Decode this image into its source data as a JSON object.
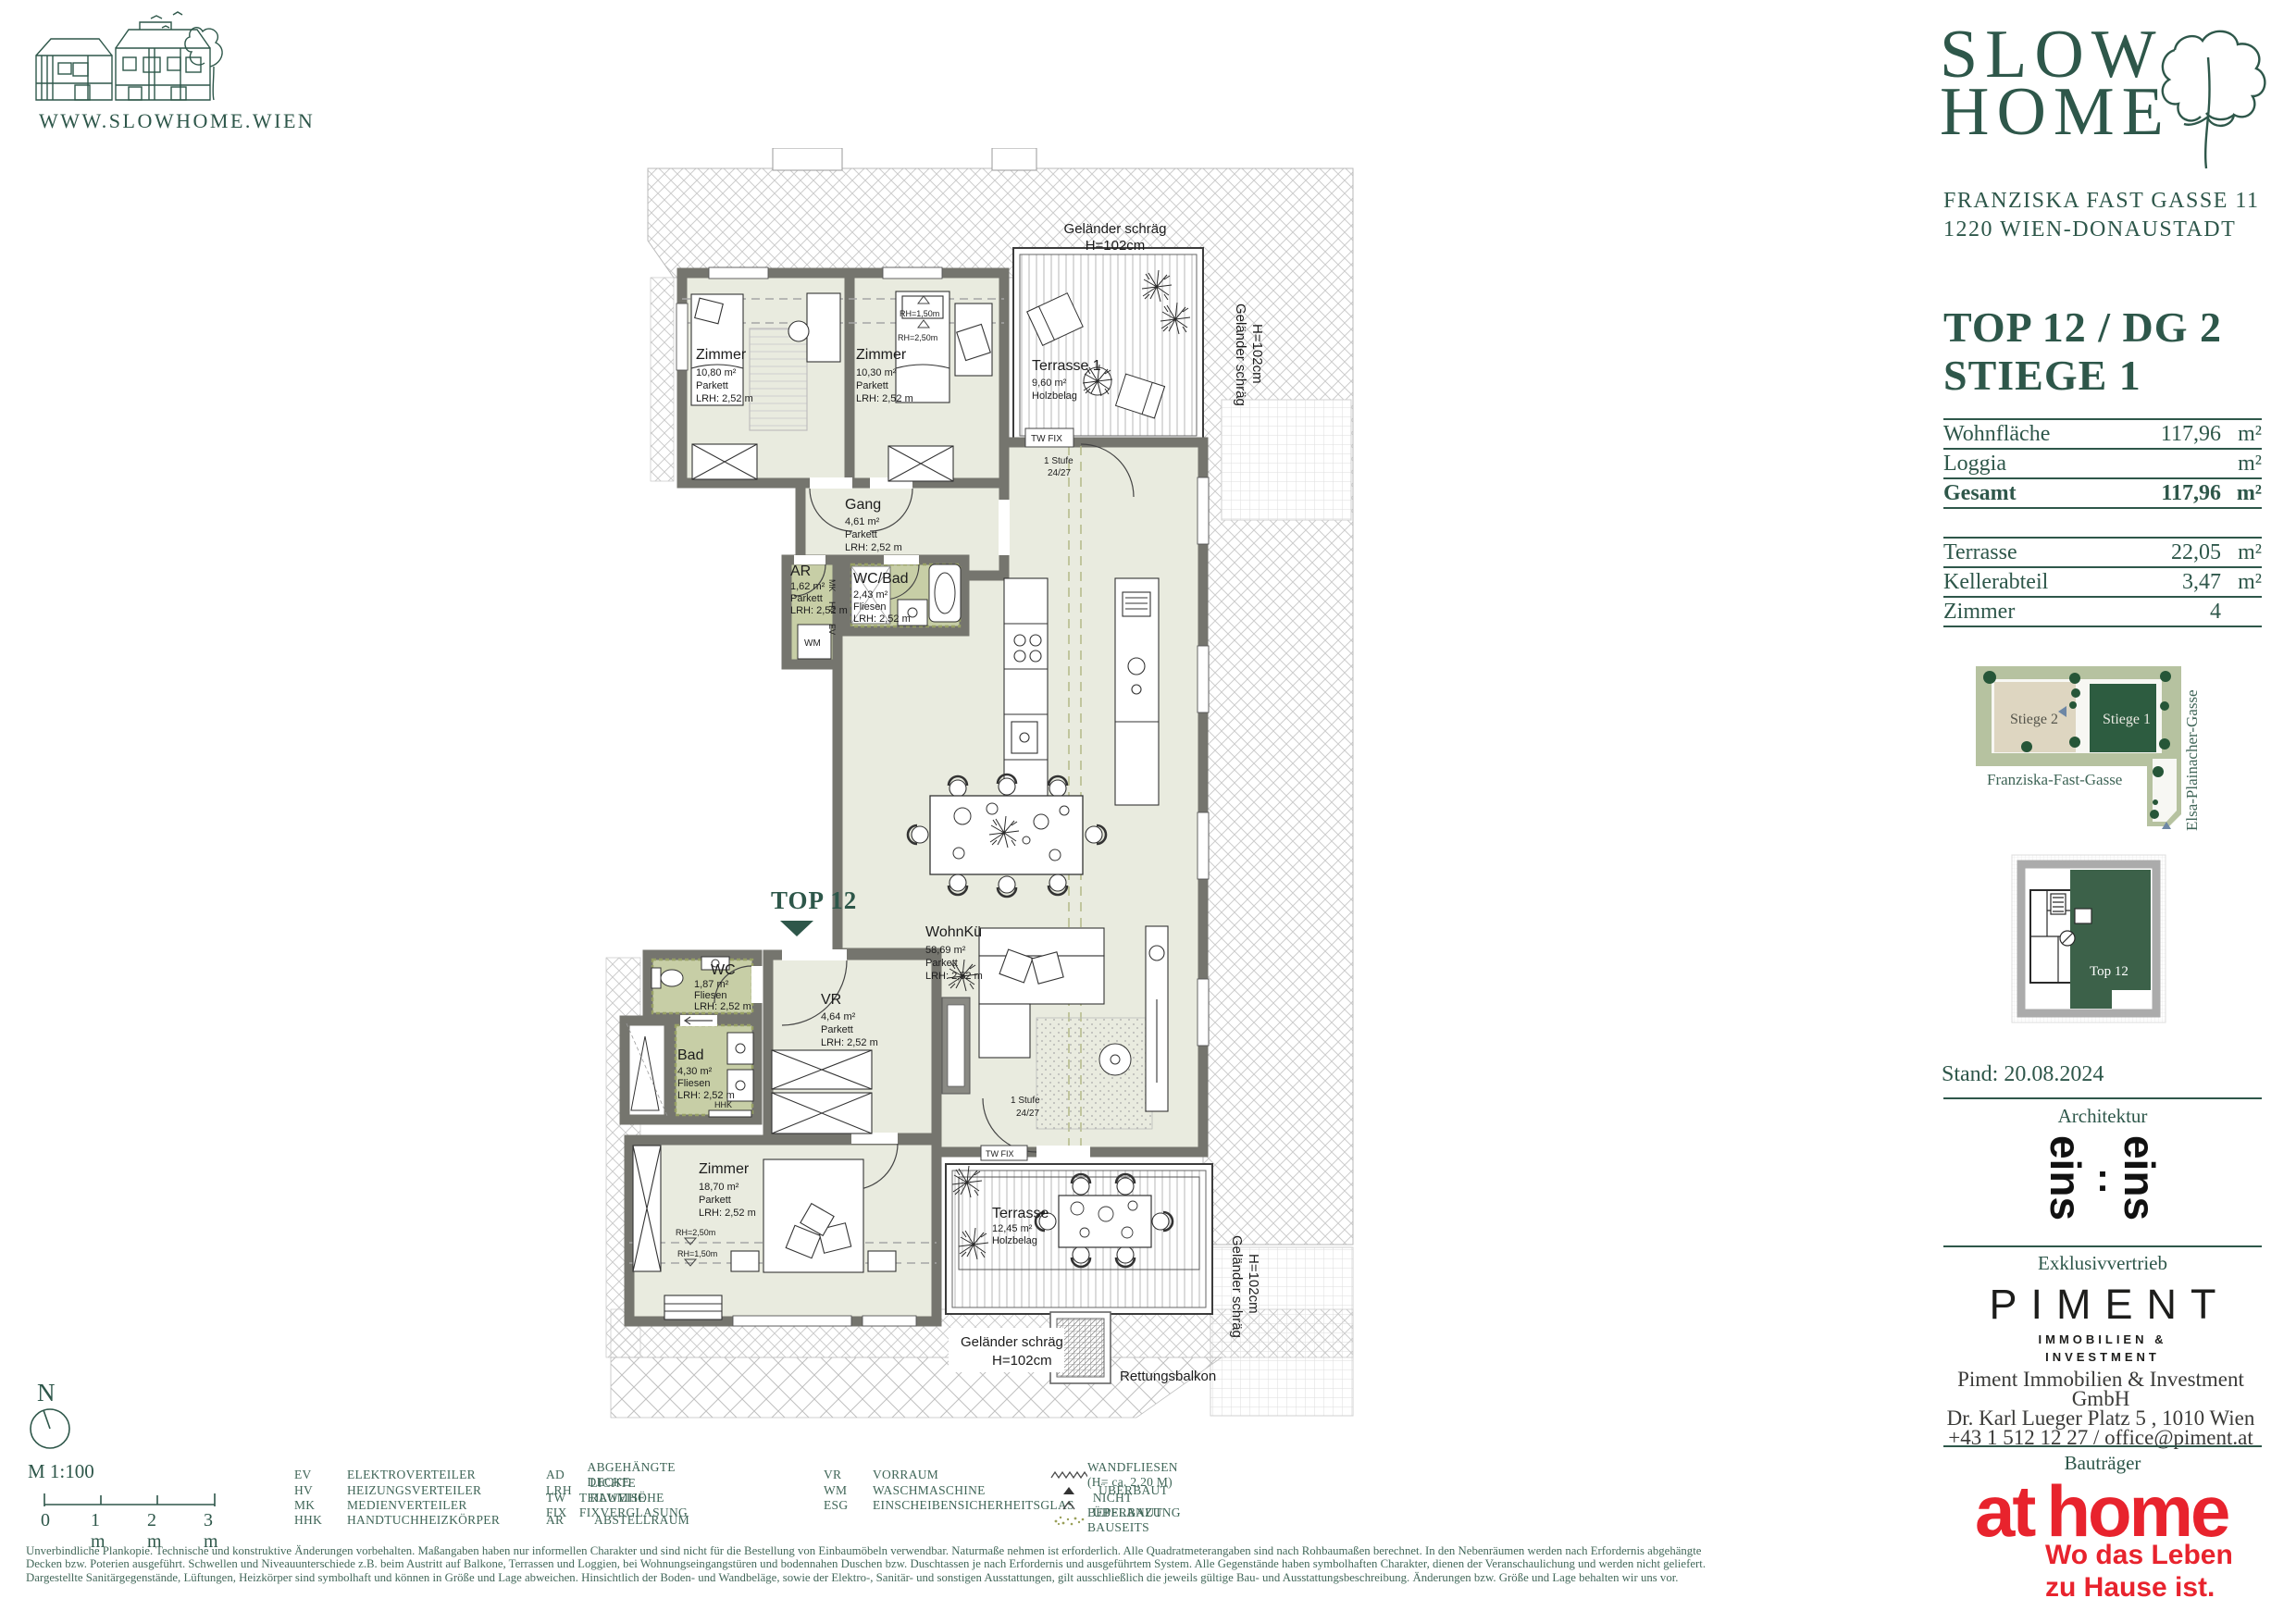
{
  "colors": {
    "brand_green": "#2e574a",
    "athome_red": "#e8232d",
    "piment_black": "#1d1d1b",
    "site_light_green": "#b6c2a0",
    "site_beige": "#ded6c1",
    "site_dark_green": "#2d5c40",
    "room_fill": "#e9ebdf",
    "wet_room_fill": "#c7cea6",
    "wall_gray": "#75756e"
  },
  "header": {
    "website": "WWW.SLOWHOME.WIEN",
    "logo_word1": "SLOW",
    "logo_word2": "HOME",
    "address_line1": "FRANZISKA FAST GASSE 11",
    "address_line2": "1220 WIEN-DONAUSTADT"
  },
  "unit": {
    "title_line1": "TOP 12 / DG 2",
    "title_line2": "STIEGE 1",
    "table": {
      "rows": [
        {
          "label": "Wohnfläche",
          "value": "117,96",
          "unit": "m²"
        },
        {
          "label": "Loggia",
          "value": "",
          "unit": "m²"
        },
        {
          "label": "Gesamt",
          "value": "117,96",
          "unit": "m²"
        },
        {
          "label": "Terrasse",
          "value": "22,05",
          "unit": "m²"
        },
        {
          "label": "Kellerabteil",
          "value": "3,47",
          "unit": "m²"
        },
        {
          "label": "Zimmer",
          "value": "4",
          "unit": ""
        }
      ]
    }
  },
  "site_plan": {
    "stiege2_label": "Stiege 2",
    "stiege1_label": "Stiege 1",
    "street_bottom": "Franziska-Fast-Gasse",
    "street_right": "Elsa-Plainacher-Gasse"
  },
  "floor_diagram": {
    "unit_label": "Top 12"
  },
  "sidebar_meta": {
    "stand": "Stand: 20.08.2024",
    "architektur_label": "Architektur",
    "architect_word_left": "eins",
    "architect_colon": ":",
    "architect_word_right": "eins",
    "vertrieb_label": "Exklusivvertrieb",
    "piment_wordmark": "PIMENT",
    "piment_sub_line1": "IMMOBILIEN &",
    "piment_sub_line2": "INVESTMENT",
    "piment_contact_line1": "Piment Immobilien & Investment GmbH",
    "piment_contact_line2": "Dr. Karl Lueger Platz 5 , 1010 Wien",
    "piment_contact_line3": "+43 1 512 12 27 / office@piment.at",
    "bautraeger_label": "Bauträger",
    "athome_word_part1": "at",
    "athome_word_part2": "home",
    "athome_tagline_line1": "Wo das Leben",
    "athome_tagline_line2": "zu Hause ist."
  },
  "plan": {
    "rooms": {
      "zimmer1": {
        "name": "Zimmer",
        "area": "10,80 m²",
        "floor": "Parkett",
        "lrh": "LRH: 2,52 m"
      },
      "zimmer2": {
        "name": "Zimmer",
        "area": "10,30 m²",
        "floor": "Parkett",
        "lrh": "LRH: 2,52 m"
      },
      "terrasse1": {
        "name": "Terrasse 1",
        "area": "9,60 m²",
        "floor": "Holzbelag"
      },
      "gang": {
        "name": "Gang",
        "area": "4,61 m²",
        "floor": "Parkett",
        "lrh": "LRH: 2,52 m"
      },
      "ar": {
        "name": "AR",
        "area": "1,62 m²",
        "floor": "Parkett",
        "lrh": "LRH: 2,52 m"
      },
      "wc_bad": {
        "name": "WC/Bad",
        "area": "2,43 m²",
        "floor": "Fliesen",
        "lrh": "LRH: 2,52 m"
      },
      "wohnkueche": {
        "name": "WohnKü",
        "area": "58,69 m²",
        "floor": "Parkett",
        "lrh": "LRH: 2,52 m"
      },
      "wc": {
        "name": "WC",
        "area": "1,87 m²",
        "floor": "Fliesen",
        "lrh": "LRH: 2,52 m"
      },
      "bad": {
        "name": "Bad",
        "area": "4,30 m²",
        "floor": "Fliesen",
        "lrh": "LRH: 2,52 m"
      },
      "vr": {
        "name": "VR",
        "area": "4,64 m²",
        "floor": "Parkett",
        "lrh": "LRH: 2,52 m"
      },
      "zimmer3": {
        "name": "Zimmer",
        "area": "18,70 m²",
        "floor": "Parkett",
        "lrh": "LRH: 2,52 m"
      },
      "terrasse2": {
        "name": "Terrasse",
        "area": "12,45 m²",
        "floor": "Holzbelag"
      }
    },
    "annotations": {
      "top_marker": "TOP 12",
      "gelaender_line1": "Geländer schräg",
      "gelaender_line2": "H=102cm",
      "tw_fix": "TW FIX",
      "stufe_line1": "1 Stufe",
      "stufe_line2": "24/27",
      "rh_150": "RH=1,50m",
      "rh_250": "RH=2,50m",
      "wm": "WM",
      "hhk": "HHK",
      "ev": "EV",
      "hv": "HV",
      "mk": "MK",
      "rettungsbalkon": "Rettungsbalkon"
    }
  },
  "scale_block": {
    "north": "N",
    "scale": "M 1:100",
    "tick0": "0",
    "tick1": "1 m",
    "tick2": "2 m",
    "tick3": "3 m"
  },
  "legend": {
    "items": [
      {
        "abbr": "EV",
        "label": "ELEKTROVERTEILER"
      },
      {
        "abbr": "HV",
        "label": "HEIZUNGSVERTEILER"
      },
      {
        "abbr": "MK",
        "label": "MEDIENVERTEILER"
      },
      {
        "abbr": "HHK",
        "label": "HANDTUCHHEIZKÖRPER"
      },
      {
        "abbr": "AD",
        "label": "ABGEHÄNGTE DECKE"
      },
      {
        "abbr": "LRH",
        "label": "LICHTE RAUMHÖHE"
      },
      {
        "abbr": "TW FIX",
        "label": "TEILWEISE FIXVERGLASUNG"
      },
      {
        "abbr": "AR",
        "label": "ABSTELLRAUM"
      },
      {
        "abbr": "VR",
        "label": "VORRAUM"
      },
      {
        "abbr": "WM",
        "label": "WASCHMASCHINE"
      },
      {
        "abbr": "ESG",
        "label": "EINSCHEIBENSICHERHEITSGLAS"
      }
    ],
    "symbols": [
      {
        "icon": "zigzag-line",
        "label": "WANDFLIESEN (H= ca. 2,20 M)"
      },
      {
        "icon": "filled-triangle",
        "label": "ÜBERBAUT"
      },
      {
        "icon": "open-triangle",
        "label": "NICHT ÜBERBAUT"
      },
      {
        "icon": "plant-dots",
        "label": "BEPFLANZUNG BAUSEITS"
      }
    ]
  },
  "disclaimer": {
    "line1": "Unverbindliche Plankopie. Technische und konstruktive Änderungen vorbehalten. Maßangaben haben nur informellen Charakter und sind nicht für die Bestellung von Einbaumöbeln verwendbar. Naturmaße nehmen ist erforderlich. Alle Quadratmeterangaben sind nach Rohbaumaßen berechnet. In den Nebenräumen werden nach Erfordernis abgehängte",
    "line2": "Decken bzw. Poterien ausgeführt. Schwellen und Niveauunterschiede z.B. beim Austritt auf Balkone, Terrassen und Loggien, bei Wohnungseingangstüren und bodennahen Duschen bzw. Duschtassen je nach Erfordernis und ausgeführtem System. Alle Gegenstände haben symbolhaften Charakter, dienen der Veranschaulichung und werden nicht geliefert.",
    "line3": "Dargestellte Sanitärgegenstände, Lüftungen, Heizkörper sind symbolhaft und können in Größe und Lage abweichen. Hinsichtlich der Boden- und Wandbeläge, sowie der Elektro-, Sanitär- und sonstigen Ausstattungen, gilt ausschließlich die jeweils gültige Bau- und Ausstattungsbeschreibung. Änderungen bzw. Größe und Lage behalten wir uns vor."
  }
}
